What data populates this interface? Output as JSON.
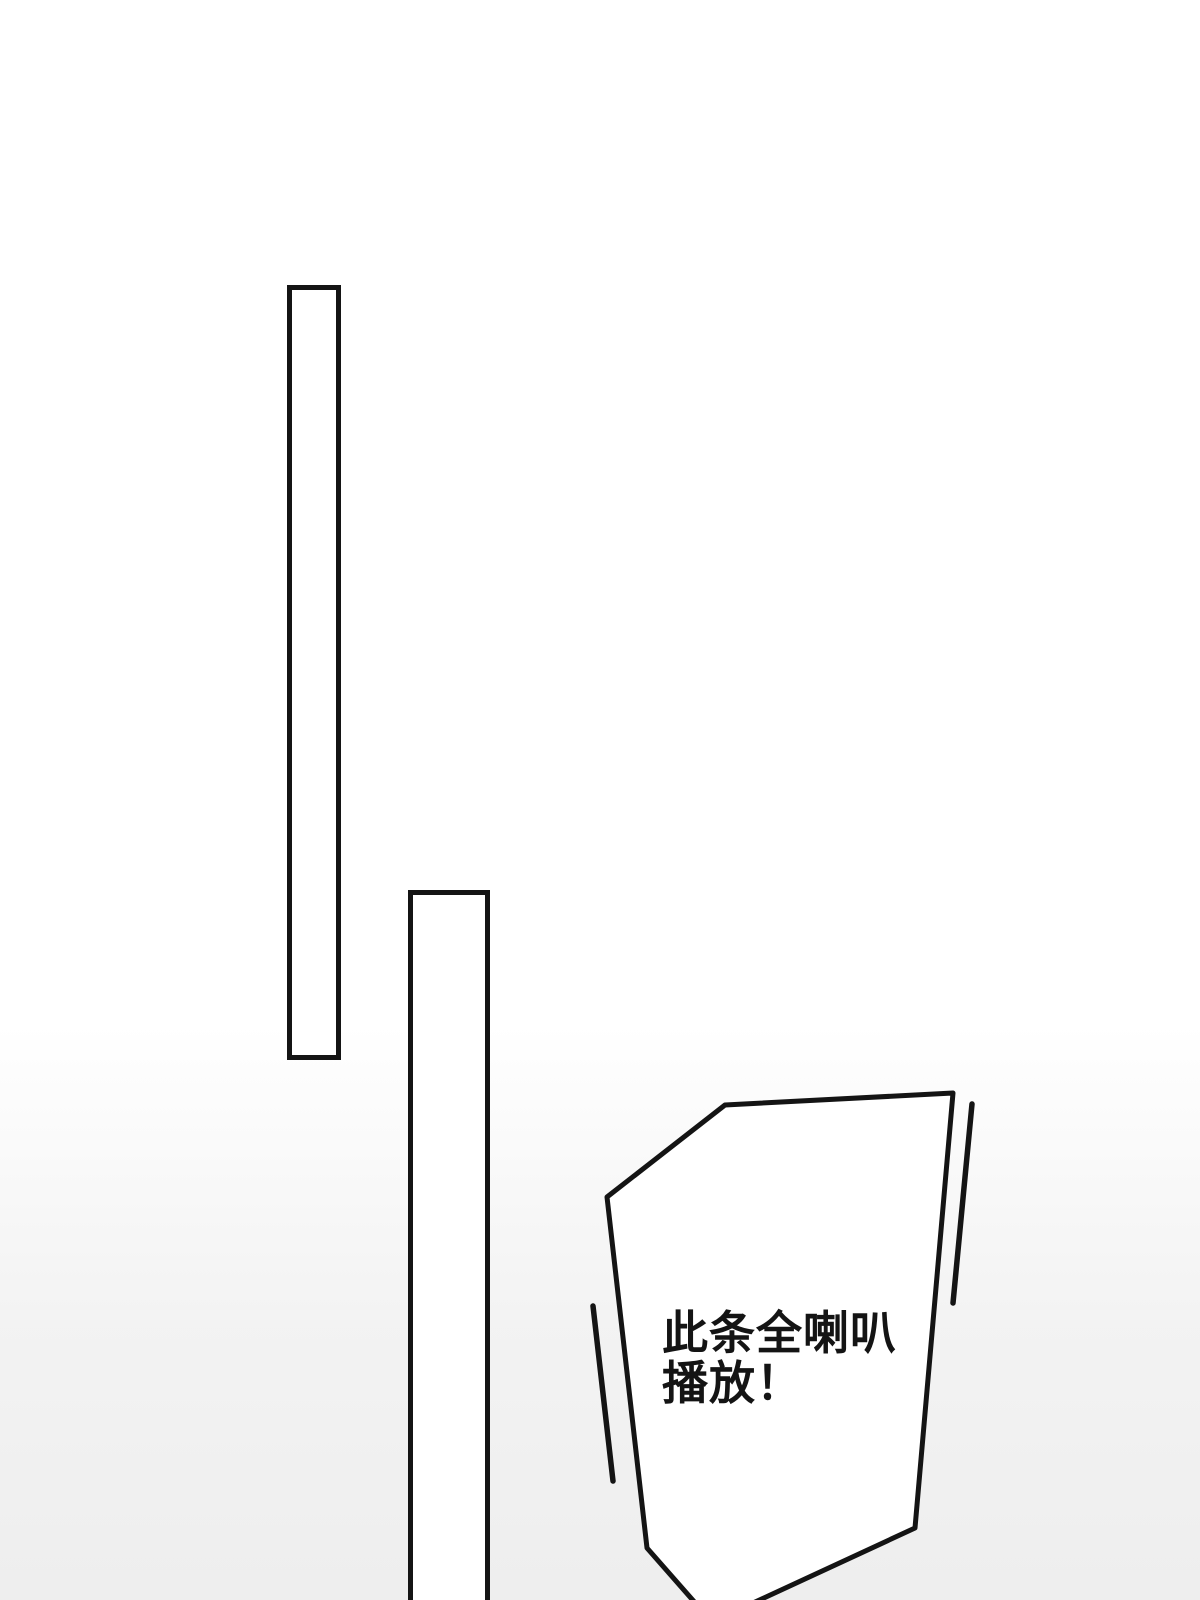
{
  "page": {
    "kind": "manga-panel",
    "colors": {
      "ink": "#141414",
      "bubble_fill": "#ffffff",
      "bg_top": "#ffffff",
      "bg_bottom": "#eeeeee"
    }
  },
  "bubble": {
    "lines": [
      "此条全喇叭",
      "播放！"
    ],
    "full_text": "此条全喇叭播放！"
  }
}
